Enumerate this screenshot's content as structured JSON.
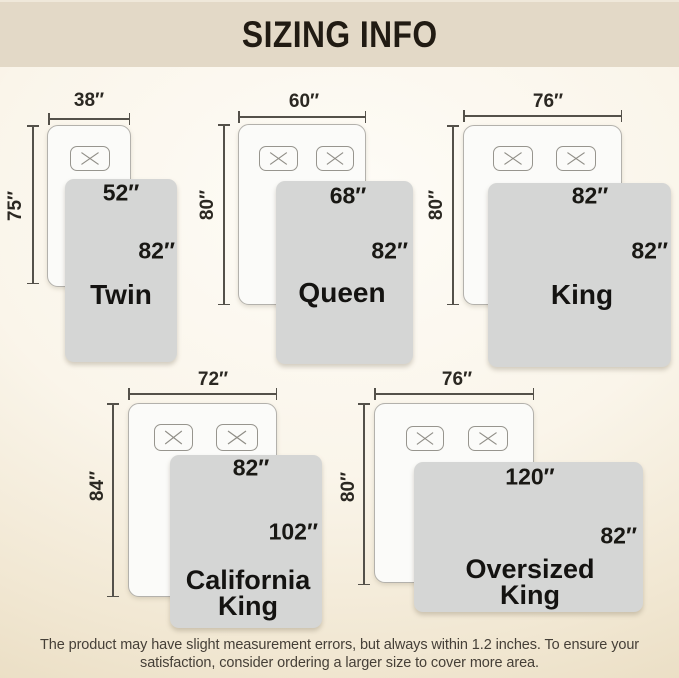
{
  "title": "SIZING INFO",
  "footer": {
    "line1": "The product may have slight measurement errors, but always within 1.2 inches. To ensure your",
    "line2": "satisfaction, consider ordering a larger size to cover more area."
  },
  "colors": {
    "banner_bg": "#e3d9c7",
    "background_center": "#fefcf7",
    "background_edge": "#e4d5b6",
    "blanket_gray": "#d5d6d5",
    "bed_fill": "#fbfbf9",
    "dimension_line": "#54514a",
    "text_dark": "#191814"
  },
  "sizes": [
    {
      "id": "twin",
      "name": "Twin",
      "name_lines": [
        "Twin"
      ],
      "mattress_width": "38″",
      "mattress_length": "75″",
      "blanket_width": "52″",
      "blanket_length": "82″",
      "pillow_count": 1
    },
    {
      "id": "queen",
      "name": "Queen",
      "name_lines": [
        "Queen"
      ],
      "mattress_width": "60″",
      "mattress_length": "80″",
      "blanket_width": "68″",
      "blanket_length": "82″",
      "pillow_count": 2
    },
    {
      "id": "king",
      "name": "King",
      "name_lines": [
        "King"
      ],
      "mattress_width": "76″",
      "mattress_length": "80″",
      "blanket_width": "82″",
      "blanket_length": "82″",
      "pillow_count": 2
    },
    {
      "id": "california-king",
      "name": "California King",
      "name_lines": [
        "California",
        "King"
      ],
      "mattress_width": "72″",
      "mattress_length": "84″",
      "blanket_width": "82″",
      "blanket_length": "102″",
      "pillow_count": 2
    },
    {
      "id": "oversized-king",
      "name": "Oversized King",
      "name_lines": [
        "Oversized",
        "King"
      ],
      "mattress_width": "76″",
      "mattress_length": "80″",
      "blanket_width": "120″",
      "blanket_length": "82″",
      "pillow_count": 2
    }
  ]
}
